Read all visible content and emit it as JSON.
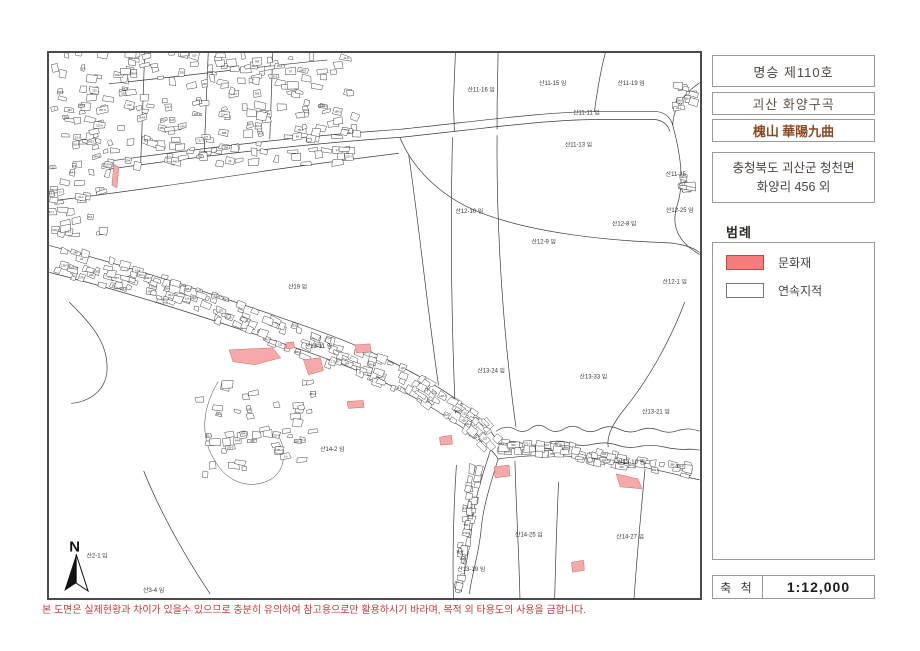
{
  "titles": {
    "designation": "명승 제110호",
    "name_korean": "괴산 화양구곡",
    "name_hanja": "槐山 華陽九曲",
    "hanja_color": "#8a4a21",
    "address_line1": "충청북도 괴산군 청천면",
    "address_line2": "화양리 456 외"
  },
  "legend": {
    "title": "범례",
    "items": [
      {
        "label": "문화재",
        "fill": "#f47c7c",
        "border": "#b94a4a"
      },
      {
        "label": "연속지적",
        "fill": "#ffffff",
        "border": "#777777"
      }
    ]
  },
  "scale": {
    "label": "축 척",
    "value": "1:12,000"
  },
  "footer": {
    "warning": "본 도면은 실제현황과 차이가 있을수 있으므로 충분히 유의하여 참고용으로만 활용하시기 바라며, 목적 외 타용도의 사용을 금합니다.",
    "color": "#c0393b"
  },
  "map": {
    "north_label": "N",
    "highlight_fill": "#f5a9a9",
    "highlight_stroke": "#c96a6a",
    "labels": [
      {
        "text": "산11-16 임",
        "x": 435,
        "y": 39
      },
      {
        "text": "산11-15 임",
        "x": 507,
        "y": 32
      },
      {
        "text": "산11-19 임",
        "x": 586,
        "y": 32
      },
      {
        "text": "산11-11 임",
        "x": 541,
        "y": 62
      },
      {
        "text": "산11-13 임",
        "x": 533,
        "y": 94
      },
      {
        "text": "산11-25",
        "x": 631,
        "y": 124
      },
      {
        "text": "산12-25 임",
        "x": 635,
        "y": 160
      },
      {
        "text": "산12-10 임",
        "x": 423,
        "y": 161
      },
      {
        "text": "산12-8 임",
        "x": 579,
        "y": 174
      },
      {
        "text": "산12-9 임",
        "x": 498,
        "y": 192
      },
      {
        "text": "산12-1 임",
        "x": 630,
        "y": 232
      },
      {
        "text": "산19 임",
        "x": 250,
        "y": 237
      },
      {
        "text": "산13-11 임",
        "x": 271,
        "y": 297
      },
      {
        "text": "산13-24 임",
        "x": 445,
        "y": 322
      },
      {
        "text": "산13-33 임",
        "x": 548,
        "y": 328
      },
      {
        "text": "산13-21 임",
        "x": 611,
        "y": 363
      },
      {
        "text": "산13-10 임",
        "x": 586,
        "y": 414
      },
      {
        "text": "산14-2 임",
        "x": 285,
        "y": 401
      },
      {
        "text": "산14-25 임",
        "x": 483,
        "y": 487
      },
      {
        "text": "산14-27 임",
        "x": 585,
        "y": 489
      },
      {
        "text": "산13-19 임",
        "x": 425,
        "y": 522
      },
      {
        "text": "산2-1 임",
        "x": 48,
        "y": 508
      },
      {
        "text": "산3-4 임",
        "x": 105,
        "y": 543
      }
    ],
    "highlights": [
      "181,299 225,297 233,307 207,314 185,311",
      "238,292 246,291 247,297 239,298",
      "256,309 273,307 276,320 261,324",
      "308,294 323,293 324,301 309,302",
      "300,351 316,350 317,357 301,358",
      "393,387 405,385 406,394 394,395",
      "448,417 463,415 464,426 449,428",
      "571,424 593,429 597,439 575,437",
      "526,513 538,511 539,521 527,523",
      "65,112 70,115 68,136 63,133"
    ]
  }
}
